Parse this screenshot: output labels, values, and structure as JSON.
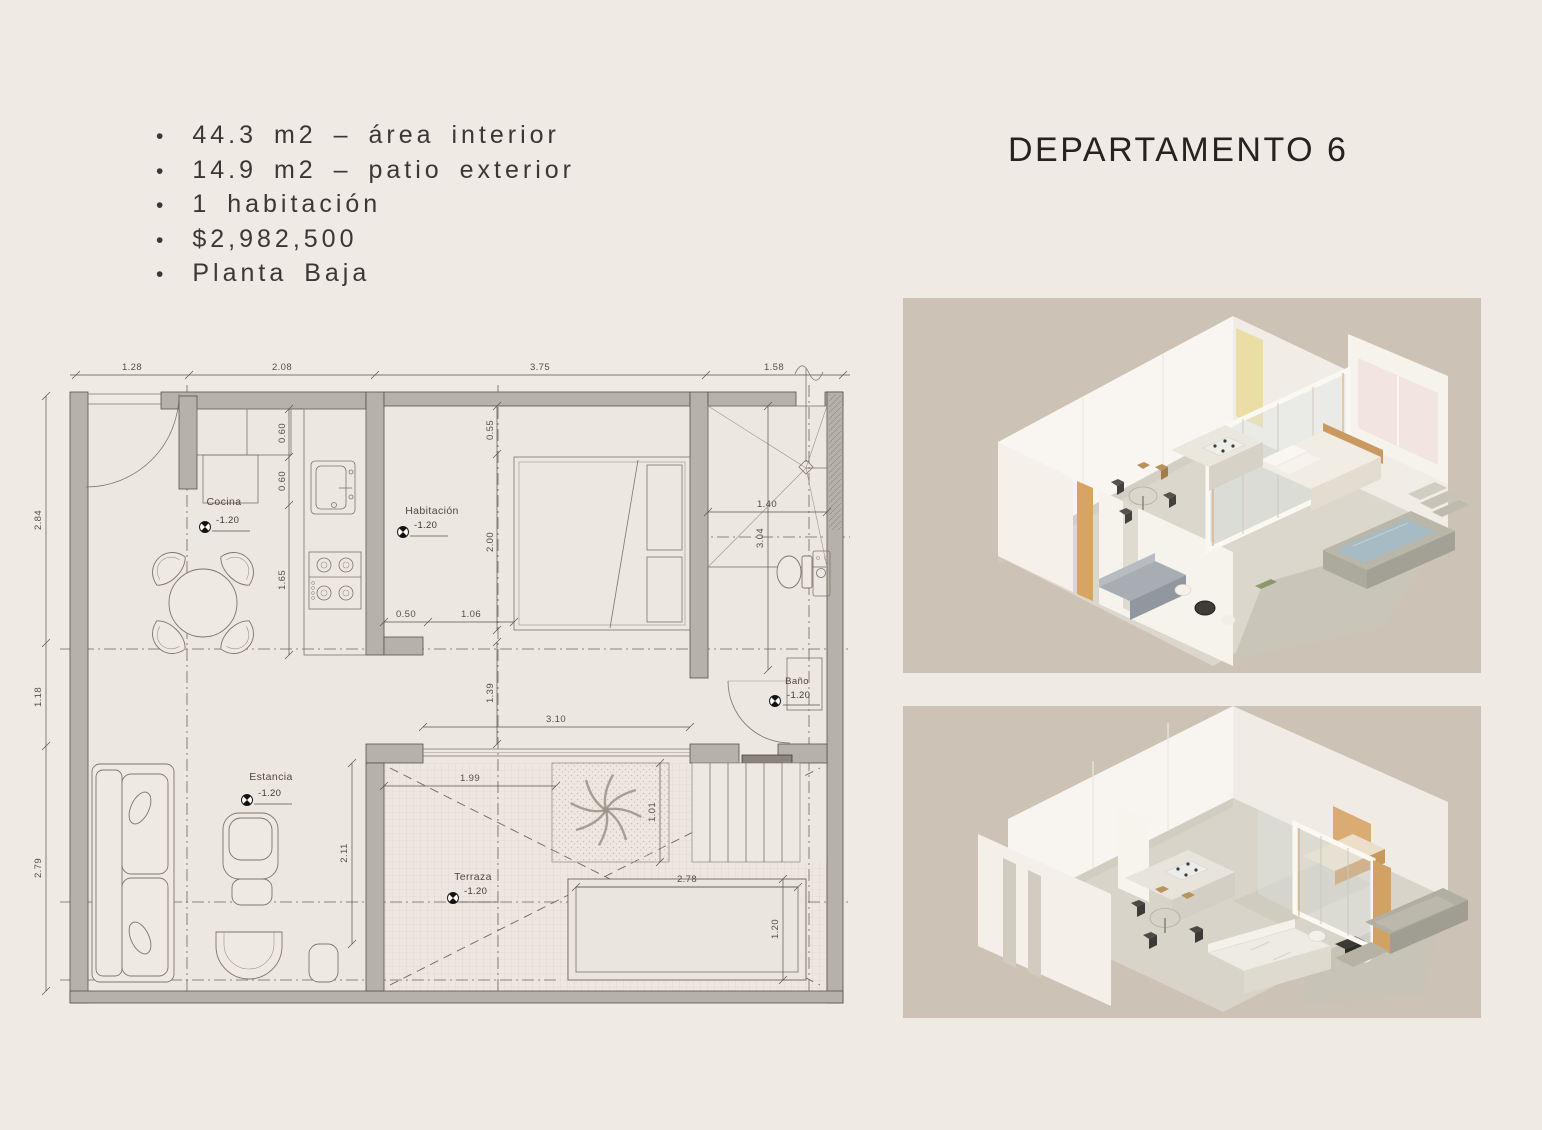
{
  "title": "DEPARTAMENTO 6",
  "specs": {
    "items": [
      "44.3 m2 – área interior",
      "14.9 m2 – patio exterior",
      "1 habitación",
      "$2,982,500",
      "Planta Baja"
    ]
  },
  "floor_plan": {
    "rooms": {
      "cocina": {
        "name": "Cocina",
        "elevation": "-1.20"
      },
      "habitacion": {
        "name": "Habitación",
        "elevation": "-1.20"
      },
      "bano": {
        "name": "Baño",
        "elevation": "-1.20"
      },
      "estancia": {
        "name": "Estancia",
        "elevation": "-1.20"
      },
      "terraza": {
        "name": "Terraza",
        "elevation": "-1.20"
      }
    },
    "dims": {
      "top": [
        "1.28",
        "2.08",
        "3.75",
        "1.58"
      ],
      "left": [
        "2.84",
        "1.18",
        "2.79"
      ],
      "closet_a": "0.60",
      "closet_b": "0.60",
      "counter": "1.65",
      "bed_offset": "0.55",
      "bed_length": "2.00",
      "hab_door": "0.50",
      "hab_wall": "1.06",
      "shower_width": "1.40",
      "bath_length": "3.04",
      "hall_height": "1.39",
      "hall_width": "3.10",
      "terrace_width": "1.99",
      "terrace_height": "2.11",
      "palm_bed": "1.01",
      "planter_width": "2.78",
      "planter_height": "1.20"
    }
  },
  "renders": {
    "top": {
      "name": "isometric-view-1"
    },
    "bottom": {
      "name": "isometric-view-2"
    }
  },
  "colors": {
    "page_bg": "#EFEAE4",
    "render_bg": "#CCC2B5",
    "wall": "#B6B2A9",
    "line": "#57514A",
    "accent_wood": "#D6A367",
    "water": "#A5BAC3",
    "utility_red": "#7E382F",
    "utility_blue": "#4A6BD0"
  }
}
